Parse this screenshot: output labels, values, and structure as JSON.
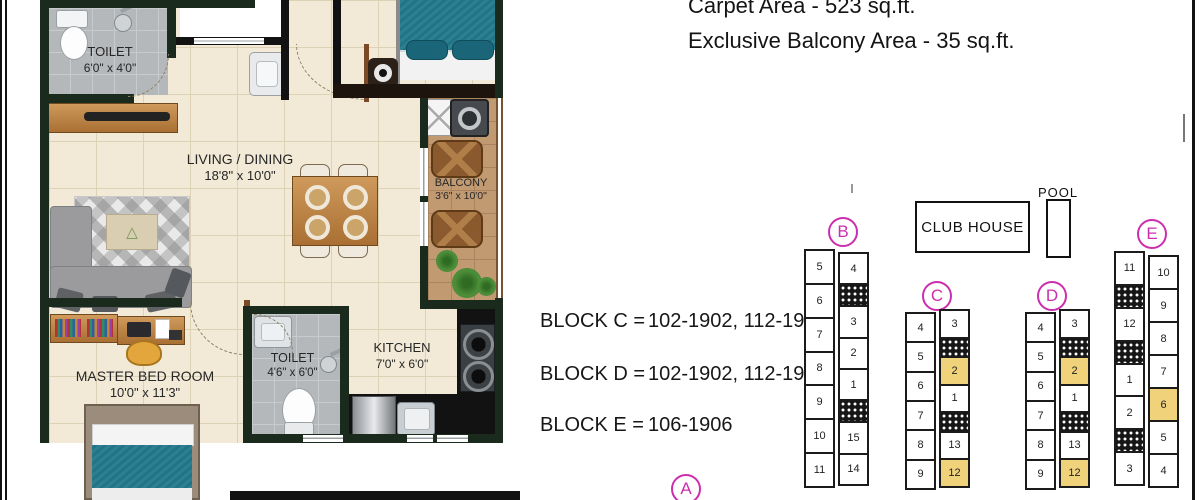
{
  "header": {
    "carpet_area_label": "Carpet Area - 523 sq.ft.",
    "balcony_area_label": "Exclusive Balcony Area - 35 sq.ft."
  },
  "blocks": [
    {
      "label": "BLOCK C =",
      "value": "102-1902, 112-1912"
    },
    {
      "label": "BLOCK D =",
      "value": "102-1902, 112-1912"
    },
    {
      "label": "BLOCK E =",
      "value": "106-1906"
    }
  ],
  "floorplan": {
    "rooms": {
      "toilet_top": {
        "name": "TOILET",
        "dims": "6'0\" x 4'0\""
      },
      "living": {
        "name": "LIVING / DINING",
        "dims": "18'8\" x 10'0\""
      },
      "balcony": {
        "name": "BALCONY",
        "dims": "3'6\" x 10'0\""
      },
      "master": {
        "name": "MASTER BED ROOM",
        "dims": "10'0\" x 11'3\""
      },
      "toilet_bottom": {
        "name": "TOILET",
        "dims": "4'6\" x 6'0\""
      },
      "kitchen": {
        "name": "KITCHEN",
        "dims": "7'0\" x 6'0\""
      }
    }
  },
  "siteplan": {
    "club_house_label": "CLUB HOUSE",
    "pool_label": "POOL",
    "markers": [
      {
        "letter": "A",
        "x": 671,
        "y": 474
      },
      {
        "letter": "B",
        "x": 828,
        "y": 217
      },
      {
        "letter": "C",
        "x": 922,
        "y": 281
      },
      {
        "letter": "D",
        "x": 1037,
        "y": 281
      },
      {
        "letter": "E",
        "x": 1137,
        "y": 219
      }
    ],
    "towers": [
      {
        "id": "B",
        "x": 804,
        "y": 249,
        "height": 251,
        "columns": [
          {
            "offset": 0,
            "cells": [
              {
                "n": "5"
              },
              {
                "n": "6"
              },
              {
                "n": "7"
              },
              {
                "n": "8"
              },
              {
                "n": "9"
              },
              {
                "n": "10"
              },
              {
                "n": "11"
              }
            ]
          },
          {
            "offset": 3,
            "cells": [
              {
                "n": "4"
              },
              {
                "core": true
              },
              {
                "n": "3"
              },
              {
                "n": "2"
              },
              {
                "n": "1"
              },
              {
                "core": true
              },
              {
                "n": "15"
              },
              {
                "n": "14"
              }
            ]
          }
        ]
      },
      {
        "id": "C",
        "x": 905,
        "y": 309,
        "height": 191,
        "columns": [
          {
            "offset": 3,
            "cells": [
              {
                "n": "4"
              },
              {
                "n": "5"
              },
              {
                "n": "6"
              },
              {
                "n": "7"
              },
              {
                "n": "8"
              },
              {
                "n": "9"
              }
            ]
          },
          {
            "offset": 0,
            "cells": [
              {
                "n": "3"
              },
              {
                "core": true
              },
              {
                "n": "2",
                "hl": true
              },
              {
                "n": "1"
              },
              {
                "core": true
              },
              {
                "n": "13"
              },
              {
                "n": "12",
                "hl": true
              }
            ]
          }
        ]
      },
      {
        "id": "D",
        "x": 1025,
        "y": 309,
        "height": 191,
        "columns": [
          {
            "offset": 3,
            "cells": [
              {
                "n": "4"
              },
              {
                "n": "5"
              },
              {
                "n": "6"
              },
              {
                "n": "7"
              },
              {
                "n": "8"
              },
              {
                "n": "9"
              }
            ]
          },
          {
            "offset": 0,
            "cells": [
              {
                "n": "3"
              },
              {
                "core": true
              },
              {
                "n": "2",
                "hl": true
              },
              {
                "n": "1"
              },
              {
                "core": true
              },
              {
                "n": "13"
              },
              {
                "n": "12",
                "hl": true
              }
            ]
          }
        ]
      },
      {
        "id": "E",
        "x": 1114,
        "y": 251,
        "height": 249,
        "columns": [
          {
            "offset": 0,
            "cells": [
              {
                "n": "11"
              },
              {
                "core": true
              },
              {
                "n": "12"
              },
              {
                "core": true
              },
              {
                "n": "1"
              },
              {
                "n": "2"
              },
              {
                "core": true
              },
              {
                "n": "3"
              }
            ]
          },
          {
            "offset": 4,
            "cells": [
              {
                "n": "10"
              },
              {
                "n": "9"
              },
              {
                "n": "8"
              },
              {
                "n": "7"
              },
              {
                "n": "6",
                "hl": true
              },
              {
                "n": "5"
              },
              {
                "n": "4"
              }
            ]
          }
        ]
      }
    ]
  },
  "colors": {
    "accent_magenta": "#cb2fad",
    "highlight_yellow": "#f0d27b",
    "wall_dark": "#1a2b1e",
    "teal_fabric": "#1f7587",
    "wood": "#b97f42",
    "line_black": "#121212"
  }
}
